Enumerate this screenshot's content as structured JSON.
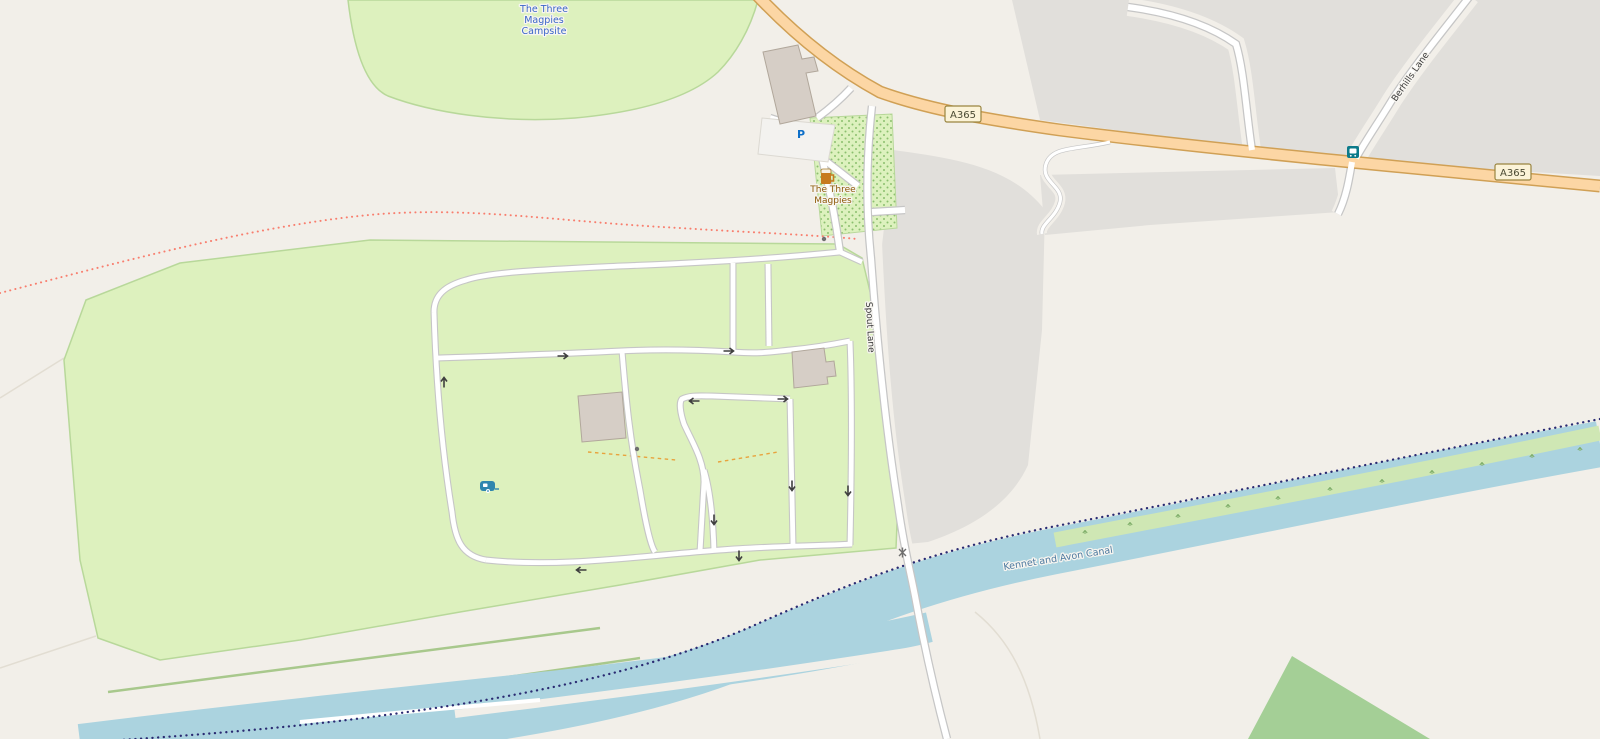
{
  "map": {
    "labels": {
      "campsite_name_line1": "The Three",
      "campsite_name_line2": "Magpies",
      "campsite_name_line3": "Campsite",
      "pub_name_line1": "The Three",
      "pub_name_line2": "Magpies",
      "road_ref": "A365",
      "road_ref_2": "A365",
      "street_spout": "Spout Lane",
      "street_berhills": "Berhills Lane",
      "waterway_name": "Kennet and Avon Canal"
    },
    "icons": [
      {
        "name": "parking-icon",
        "glyph": "P"
      },
      {
        "name": "pub-beer-mug-icon"
      },
      {
        "name": "bus-stop-icon"
      },
      {
        "name": "caravan-site-icon"
      },
      {
        "name": "gate-marker-icon"
      },
      {
        "name": "crossing-marker-icon"
      },
      {
        "name": "oneway-arrow-icon"
      }
    ],
    "oneway_arrows": [
      {
        "x": 563,
        "y": 356,
        "deg": 0
      },
      {
        "x": 729,
        "y": 351,
        "deg": 0
      },
      {
        "x": 444,
        "y": 382,
        "deg": -90
      },
      {
        "x": 694,
        "y": 401,
        "deg": 180
      },
      {
        "x": 783,
        "y": 399,
        "deg": 0
      },
      {
        "x": 714,
        "y": 520,
        "deg": 90
      },
      {
        "x": 792,
        "y": 486,
        "deg": 90
      },
      {
        "x": 848,
        "y": 491,
        "deg": 90
      },
      {
        "x": 581,
        "y": 570,
        "deg": 180
      },
      {
        "x": 739,
        "y": 556,
        "deg": 90
      }
    ],
    "colors": {
      "background": "#f2efe9",
      "campsite_green": "#ddf1be",
      "grass_outline": "#b8d89a",
      "farmland_gray": "#e1dfdb",
      "water": "#abd3df",
      "canal_bank_green": "#cfe7b4",
      "woodland_green": "#a4cf96",
      "primary_road_fill": "#fcd6a4",
      "primary_road_casing": "#d0a055",
      "minor_road_fill": "#ffffff",
      "minor_road_casing": "#c6c6c6",
      "building_fill": "#d6cec6",
      "building_outline": "#b1a79b",
      "footpath_dots": "#f87e6e",
      "towpath_dots": "#2a2a72",
      "campsite_label_blue": "#3a66c8",
      "pub_label_amber": "#8d5a08",
      "water_label_blue": "#4d7aa0",
      "road_label_gray": "#3a3a3a",
      "shield_bg": "#fbf3d8",
      "shield_border": "#9a8540"
    }
  }
}
